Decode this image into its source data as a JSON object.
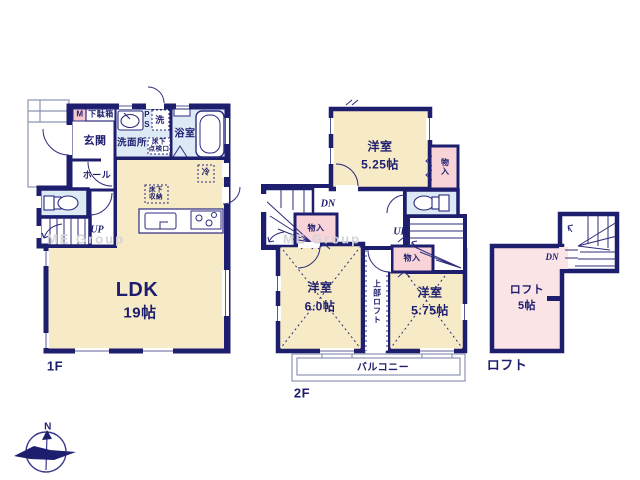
{
  "watermark": "ME Group",
  "f1": {
    "label": "1F",
    "m": "M",
    "shoebox": "下駄箱",
    "genkan": "玄関",
    "washroom": "洗面所",
    "ps": "PS",
    "wash": "洗",
    "inspection": "床下\n点検口",
    "bath": "浴室",
    "hall": "ホール",
    "fridge": "冷",
    "storage": "床下\n収納",
    "up": "UP",
    "ldk": "LDK",
    "ldk_area": "19帖"
  },
  "f2": {
    "label": "2F",
    "room": "洋室",
    "room1_area": "5.25帖",
    "room2_area": "6.0帖",
    "room3_area": "5.75帖",
    "closet": "物入",
    "dn": "DN",
    "up": "UP",
    "upper_loft": "上部ロフト",
    "balcony": "バルコニー"
  },
  "loft": {
    "label": "ロフト",
    "name": "ロフト",
    "area": "5帖",
    "dn": "DN"
  },
  "compass": {
    "n": "N"
  }
}
